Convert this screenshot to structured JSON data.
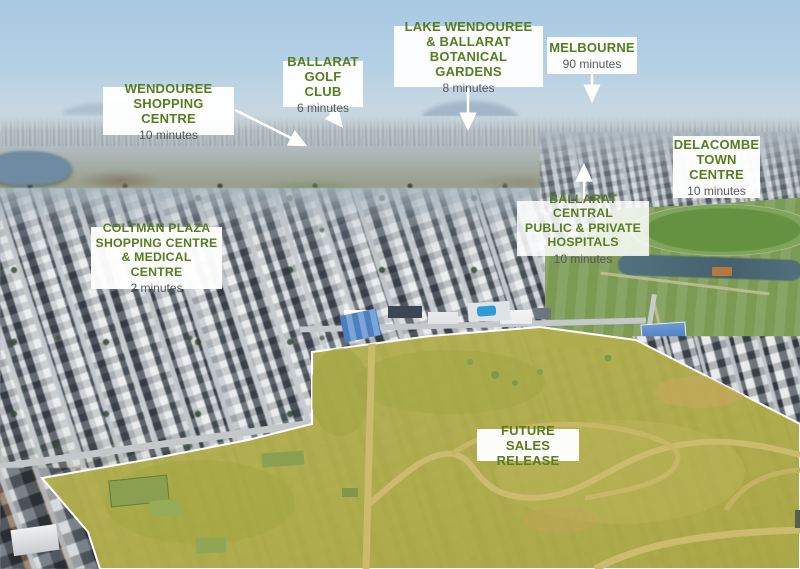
{
  "page": {
    "width": 800,
    "height": 569,
    "description": "Aerial marketing map of a Ballarat housing estate with drive-time callouts"
  },
  "colors": {
    "label_green": "#567d1f",
    "minutes_gray": "#58595b",
    "box_white": "#ffffff",
    "arrow_white": "#ffffff",
    "highlight_yellow": "#b2ae4a"
  },
  "callouts": {
    "wendouree": {
      "lines": [
        "WENDOUREE",
        "SHOPPING CENTRE"
      ],
      "time": "10 minutes"
    },
    "golf": {
      "lines": [
        "BALLARAT",
        "GOLF CLUB"
      ],
      "time": "6 minutes"
    },
    "lake": {
      "lines": [
        "LAKE WENDOUREE",
        "& BALLARAT",
        "BOTANICAL GARDENS"
      ],
      "time": "8 minutes"
    },
    "melbourne": {
      "lines": [
        "MELBOURNE"
      ],
      "time": "90 minutes"
    },
    "delacombe": {
      "lines": [
        "DELACOMBE",
        "TOWN",
        "CENTRE"
      ],
      "time": "10 minutes"
    },
    "hospitals": {
      "lines": [
        "BALLARAT CENTRAL",
        "PUBLIC & PRIVATE",
        "HOSPITALS"
      ],
      "time": "10 minutes"
    },
    "coltman": {
      "lines": [
        "COLTMAN PLAZA",
        "SHOPPING CENTRE",
        "& MEDICAL CENTRE"
      ],
      "time": "2 minutes"
    },
    "future": {
      "lines": [
        "FUTURE SALES",
        "RELEASE"
      ]
    }
  }
}
